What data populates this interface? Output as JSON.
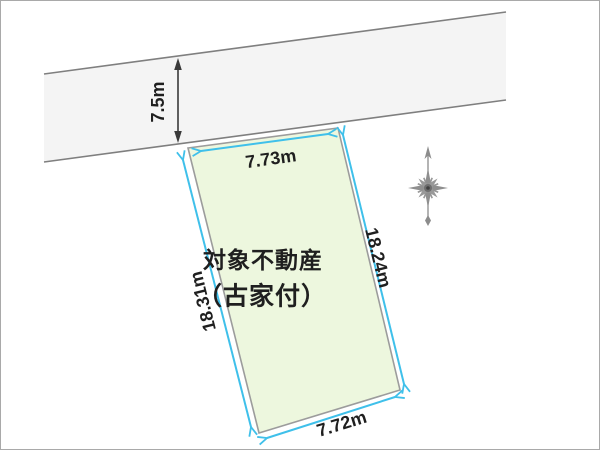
{
  "diagram_type": "land-plot-survey-sketch",
  "plot": {
    "label_line1": "対象不動産",
    "label_line2": "（古家付）",
    "frontage_length": "7.73m",
    "left_side_length": "18.31m",
    "right_side_length": "18.24m",
    "rear_length": "7.72m"
  },
  "road": {
    "width_label": "7.5m"
  },
  "compass": {
    "meaning": "north-up"
  },
  "colors": {
    "plot_fill": "#edf7de",
    "road_fill": "#f4f4f4",
    "dimension_arrow": "#3fc0ea",
    "outline_gray": "#9c9c9c",
    "road_edge_gray": "#7f7f7f",
    "text": "#1f1f1f",
    "compass_gray": "#8c8c8c"
  }
}
